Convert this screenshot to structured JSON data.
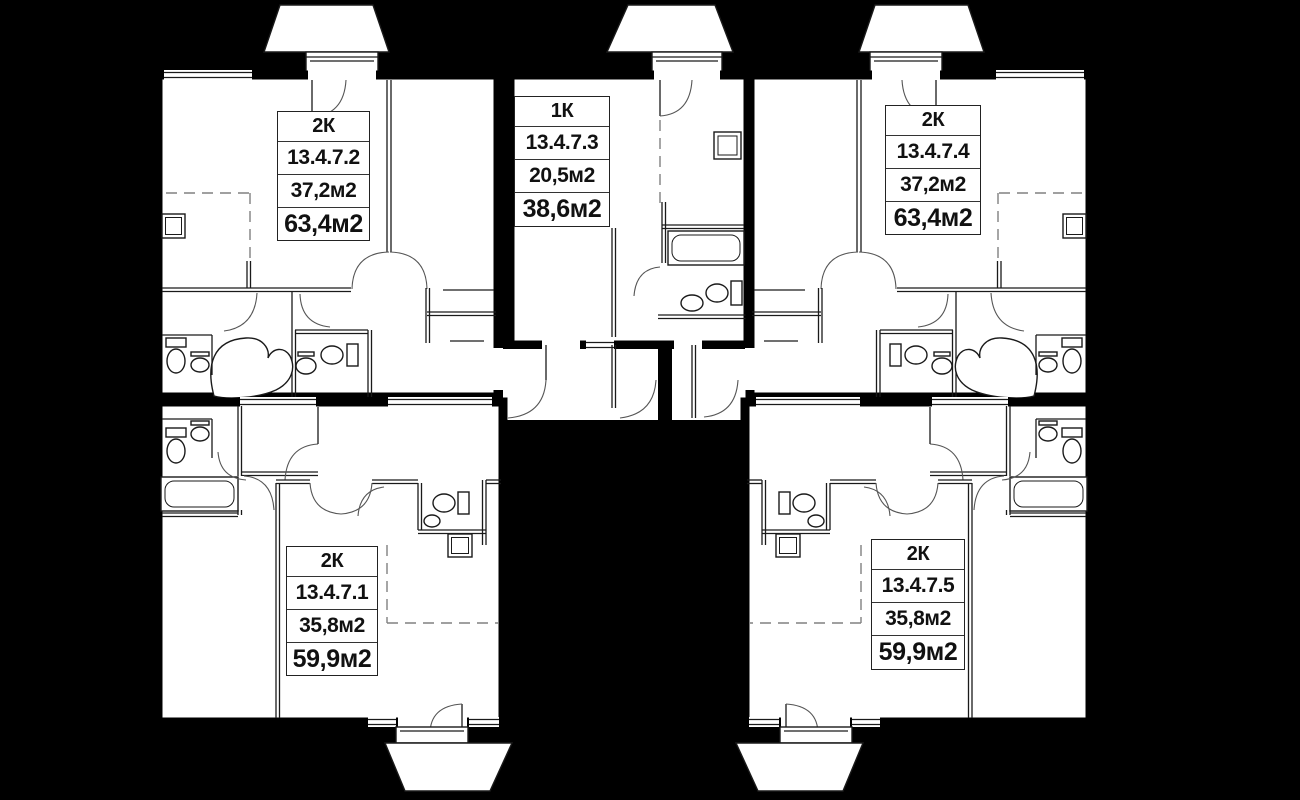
{
  "plan_title": "Residential floor plan, section 13.4.7",
  "colors": {
    "background": "#000000",
    "walls": "#000000",
    "floor": "#ffffff",
    "thin_line": "#1a1a1a",
    "dashed_line": "#808080"
  },
  "apartments": [
    {
      "type": "2К",
      "number": "13.4.7.1",
      "living_area": "35,8м2",
      "total_area": "59,9м2",
      "position": "bottom-left"
    },
    {
      "type": "2К",
      "number": "13.4.7.2",
      "living_area": "37,2м2",
      "total_area": "63,4м2",
      "position": "top-left"
    },
    {
      "type": "1К",
      "number": "13.4.7.3",
      "living_area": "20,5м2",
      "total_area": "38,6м2",
      "position": "top-middle"
    },
    {
      "type": "2К",
      "number": "13.4.7.4",
      "living_area": "37,2м2",
      "total_area": "63,4м2",
      "position": "top-right"
    },
    {
      "type": "2К",
      "number": "13.4.7.5",
      "living_area": "35,8м2",
      "total_area": "59,9м2",
      "position": "bottom-right"
    }
  ]
}
